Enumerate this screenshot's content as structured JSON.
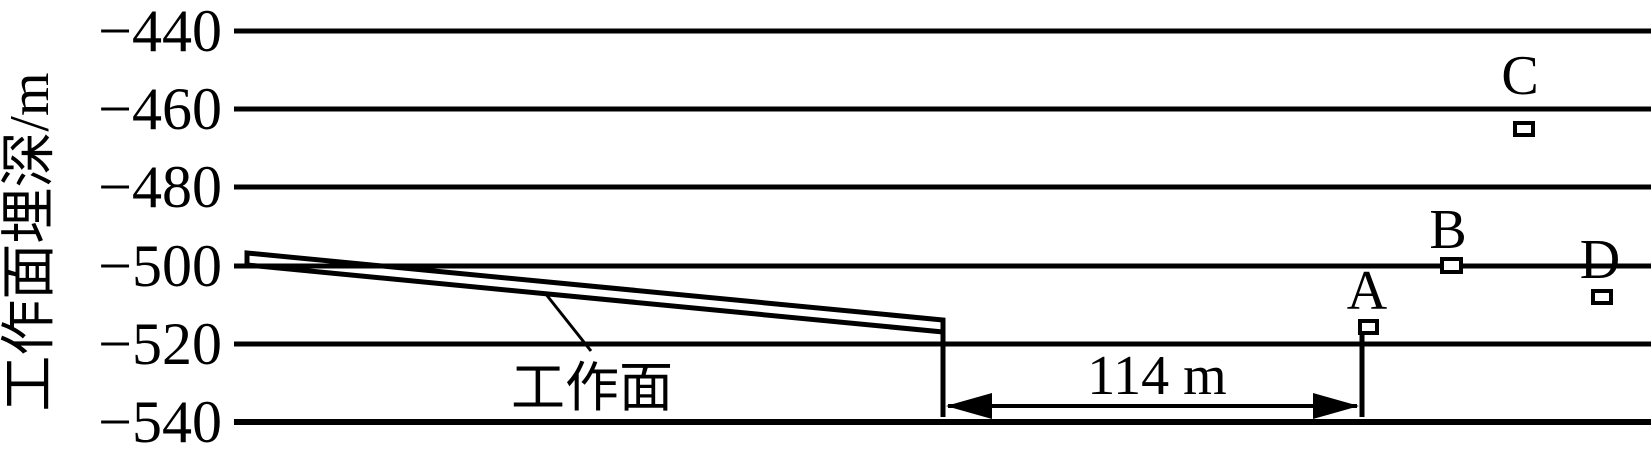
{
  "figure": {
    "background_color": "#ffffff",
    "ink_color": "#000000"
  },
  "chart_data": {
    "type": "scatter",
    "title": "",
    "xlabel": "",
    "ylabel": "工作面埋深/m",
    "ytick_labels": [
      "−440",
      "−460",
      "−480",
      "−500",
      "−520",
      "−540"
    ],
    "ytick_values": [
      -440,
      -460,
      -480,
      -500,
      -520,
      -540
    ],
    "ylim": [
      -545,
      -435
    ],
    "grid": "horizontal gridlines at every y tick",
    "legend_position": "none",
    "marker_style": "small hollow square",
    "points": [
      {
        "label": "A",
        "depth_m": -516
      },
      {
        "label": "B",
        "depth_m": -500
      },
      {
        "label": "C",
        "depth_m": -465
      },
      {
        "label": "D",
        "depth_m": -508
      }
    ],
    "working_face": {
      "label": "工作面",
      "shape": "inclined double-line band sloping down to the right",
      "top_edge_depth_m": {
        "start": -497,
        "end": -514
      },
      "bottom_edge_depth_m": {
        "start": -500,
        "end": -517
      }
    },
    "annotations": {
      "distance": {
        "label": "114 m",
        "description": "double-headed horizontal dimension arrow between the working-face end line and the vertical line at point A"
      }
    }
  }
}
